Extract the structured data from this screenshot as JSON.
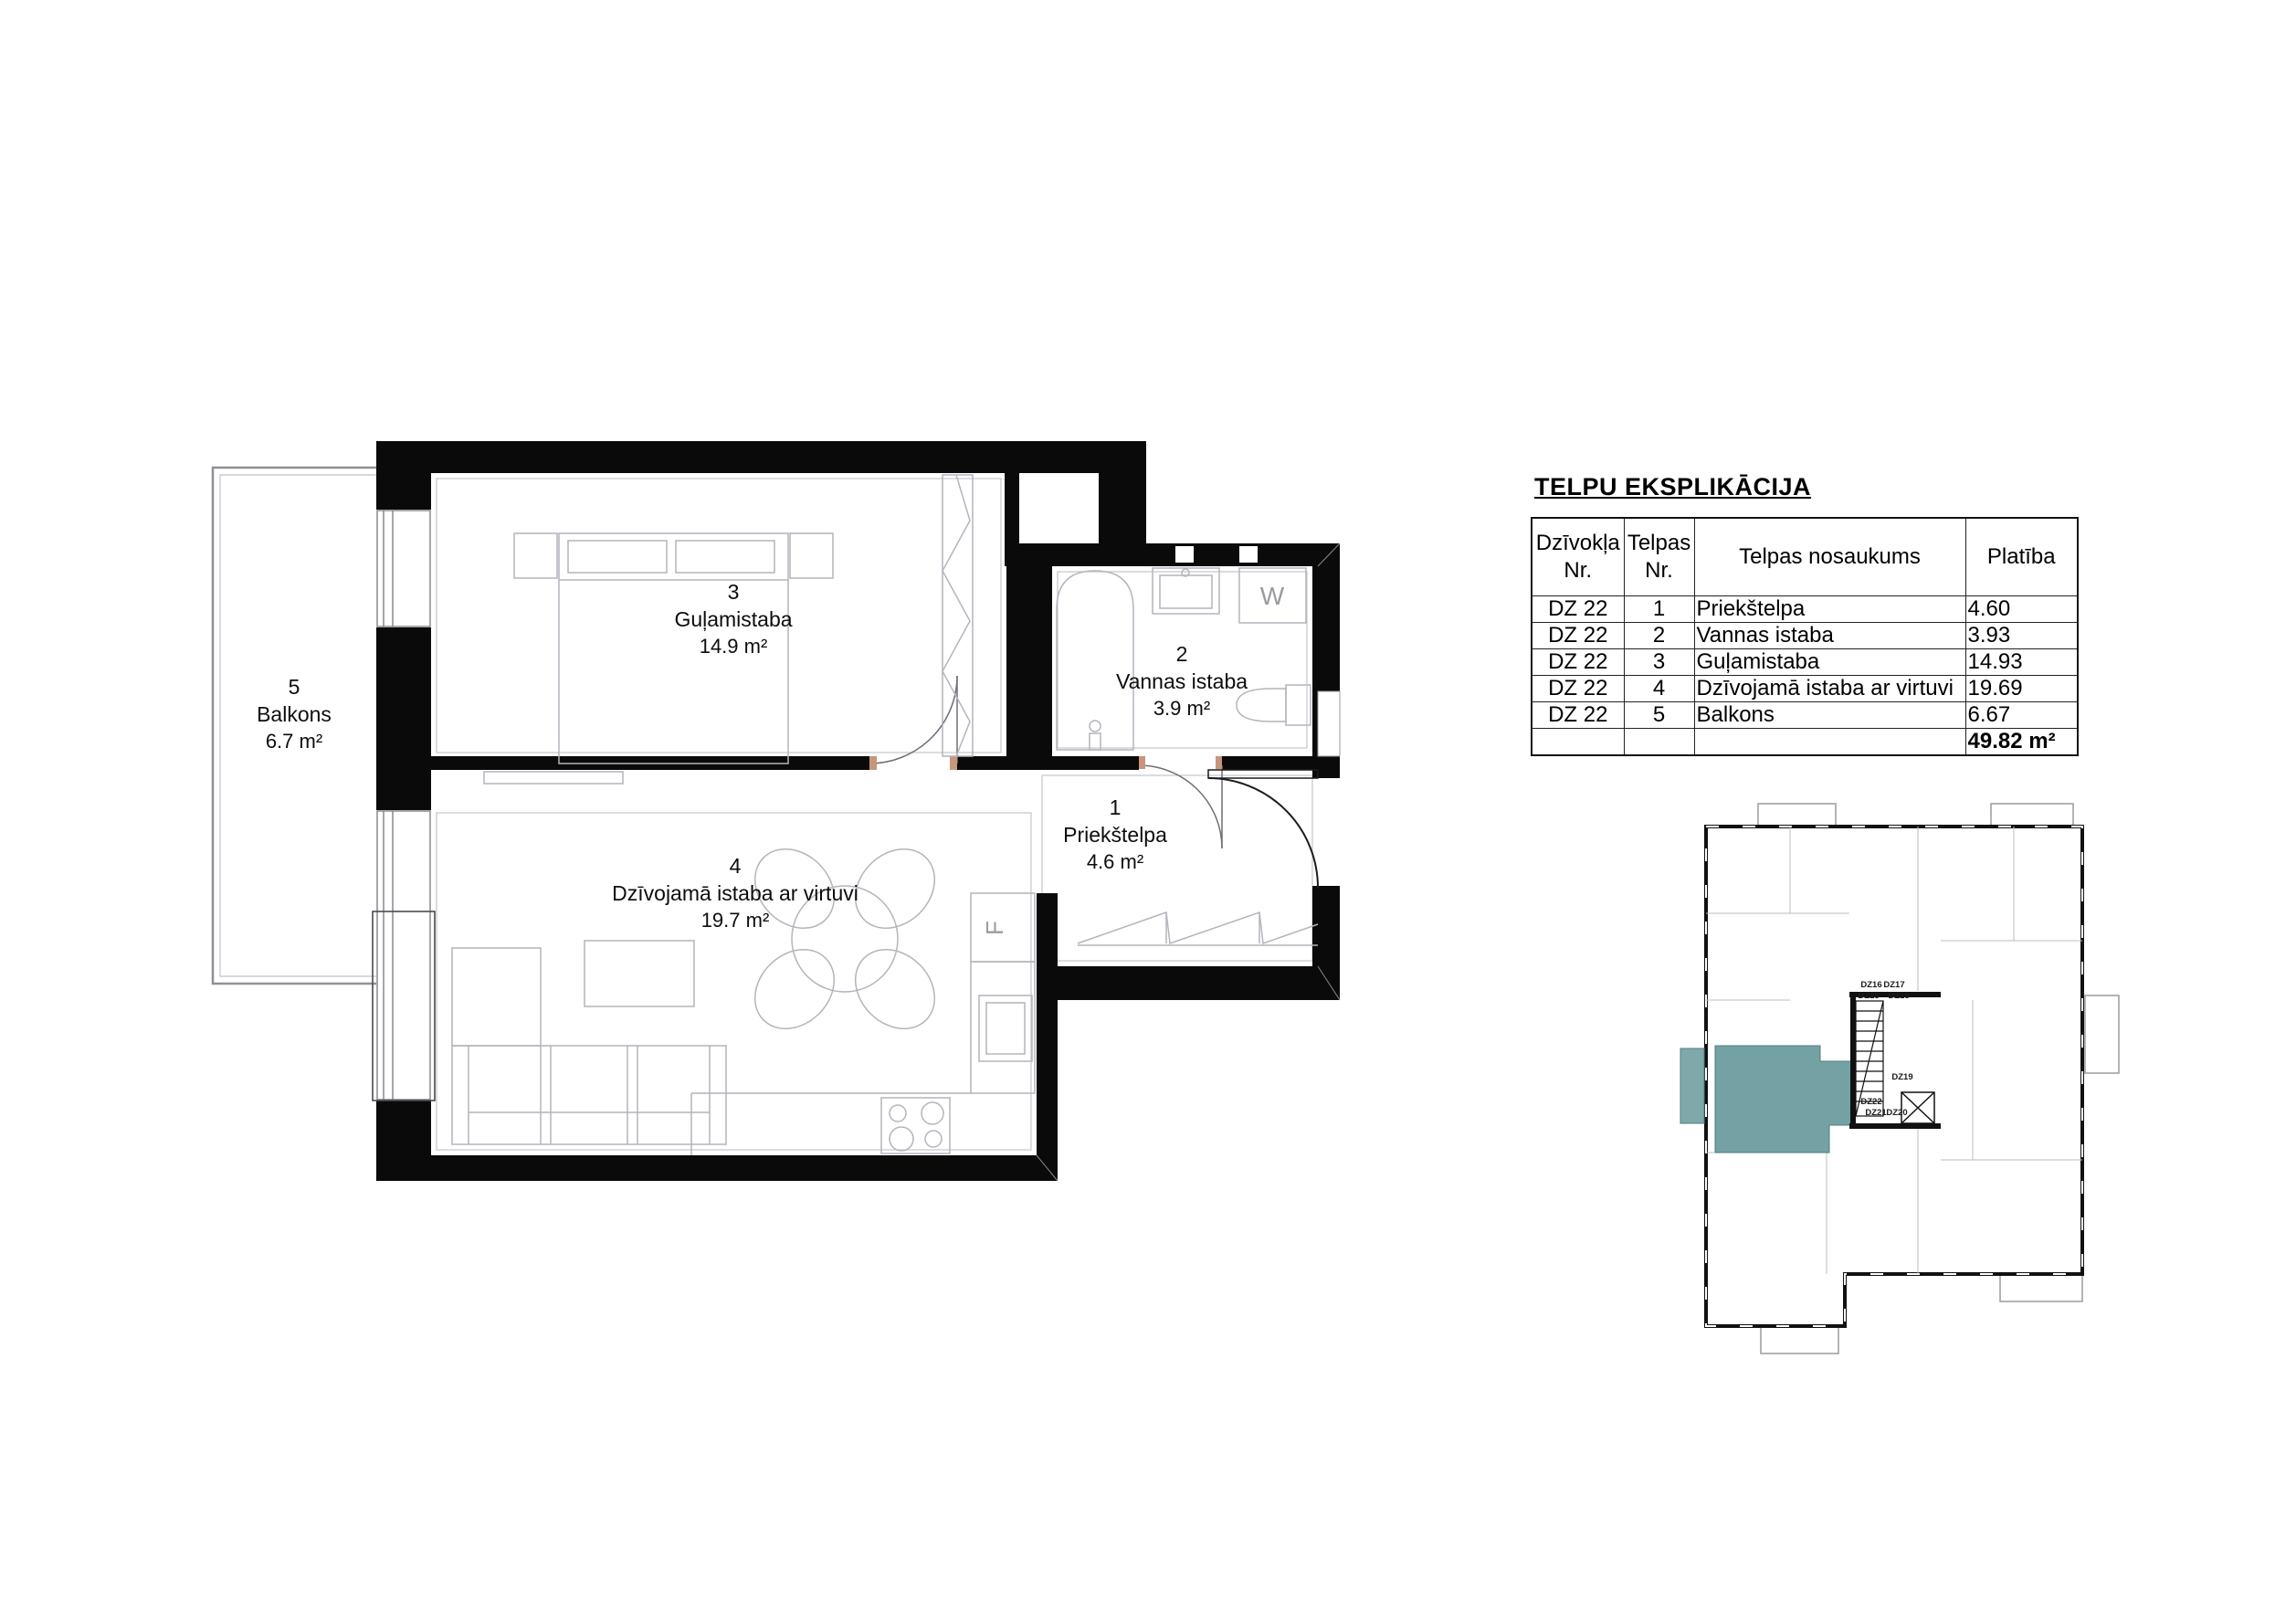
{
  "explication": {
    "title": "TELPU EKSPLIKĀCIJA",
    "columns": [
      {
        "line1": "Dzīvokļa",
        "line2": "Nr."
      },
      {
        "line1": "Telpas",
        "line2": "Nr."
      },
      {
        "line1": "Telpas nosaukums",
        "line2": ""
      },
      {
        "line1": "Platība",
        "line2": ""
      }
    ],
    "rows": [
      {
        "apt": "DZ 22",
        "room_no": "1",
        "room_name": "Priekštelpa",
        "area": "4.60"
      },
      {
        "apt": "DZ 22",
        "room_no": "2",
        "room_name": "Vannas istaba",
        "area": "3.93"
      },
      {
        "apt": "DZ 22",
        "room_no": "3",
        "room_name": "Guļamistaba",
        "area": "14.93"
      },
      {
        "apt": "DZ 22",
        "room_no": "4",
        "room_name": "Dzīvojamā istaba ar virtuvi",
        "area": "19.69"
      },
      {
        "apt": "DZ 22",
        "room_no": "5",
        "room_name": "Balkons",
        "area": "6.67"
      }
    ],
    "total_area": "49.82 m²"
  },
  "floorplan": {
    "room_labels": [
      {
        "number": "5",
        "name": "Balkons",
        "area": "6.7 m²"
      },
      {
        "number": "3",
        "name": "Guļamistaba",
        "area": "14.9 m²"
      },
      {
        "number": "2",
        "name": "Vannas istaba",
        "area": "3.9 m²"
      },
      {
        "number": "1",
        "name": "Priekštelpa",
        "area": "4.6 m²"
      },
      {
        "number": "4",
        "name": "Dzīvojamā istaba ar virtuvi",
        "area": "19.7 m²"
      }
    ],
    "appliances": {
      "washer": "W",
      "fridge": "F"
    }
  },
  "keyplan": {
    "highlight_color": "#68999b",
    "units": [
      "DZ16",
      "DZ17",
      "DZ15",
      "DZ18",
      "DZ19",
      "DZ22",
      "DZ21",
      "DZ20"
    ]
  }
}
